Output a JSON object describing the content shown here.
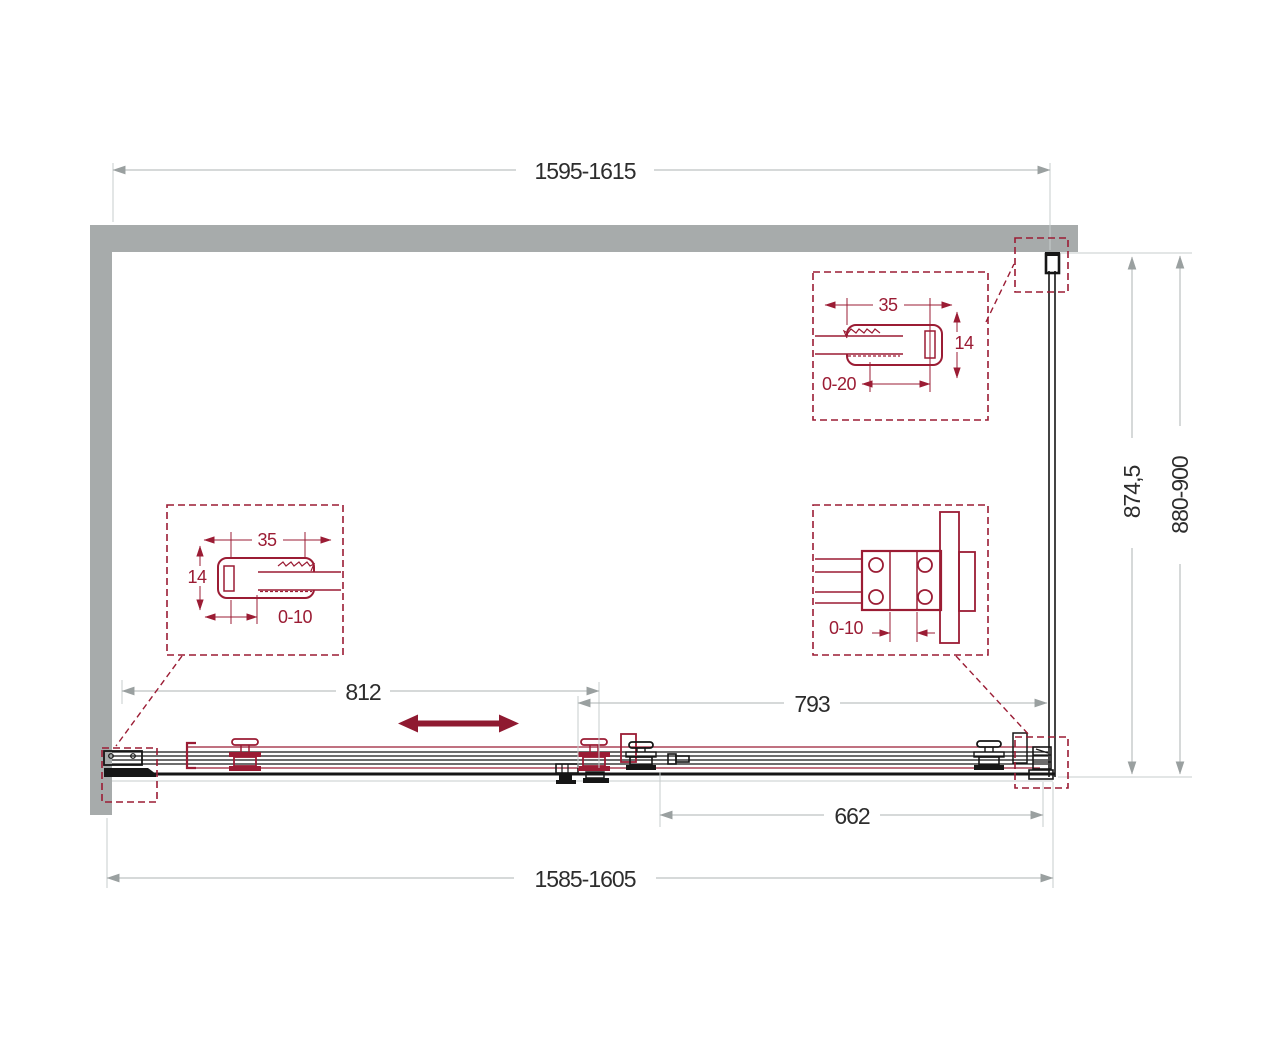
{
  "drawing": {
    "type": "shower-enclosure-plan-technical-drawing",
    "colors": {
      "wall_gray": "#a7abab",
      "accent_maroon": "#9b1c34",
      "line_black": "#161616",
      "dim_line_gray": "#adb3b3",
      "text_dark": "#2d2d2d"
    },
    "dims": {
      "top_width": "1595-1615",
      "bottom_width": "1585-1605",
      "door_opening": "812",
      "door_panel": "793",
      "fixed_panel": "662",
      "side_glass": "874,5",
      "side_depth": "880-900"
    },
    "detail_left": {
      "width": "35",
      "height": "14",
      "range": "0-10"
    },
    "detail_top_right": {
      "width": "35",
      "height": "14",
      "range": "0-20"
    },
    "detail_bracket": {
      "range": "0-10"
    }
  }
}
